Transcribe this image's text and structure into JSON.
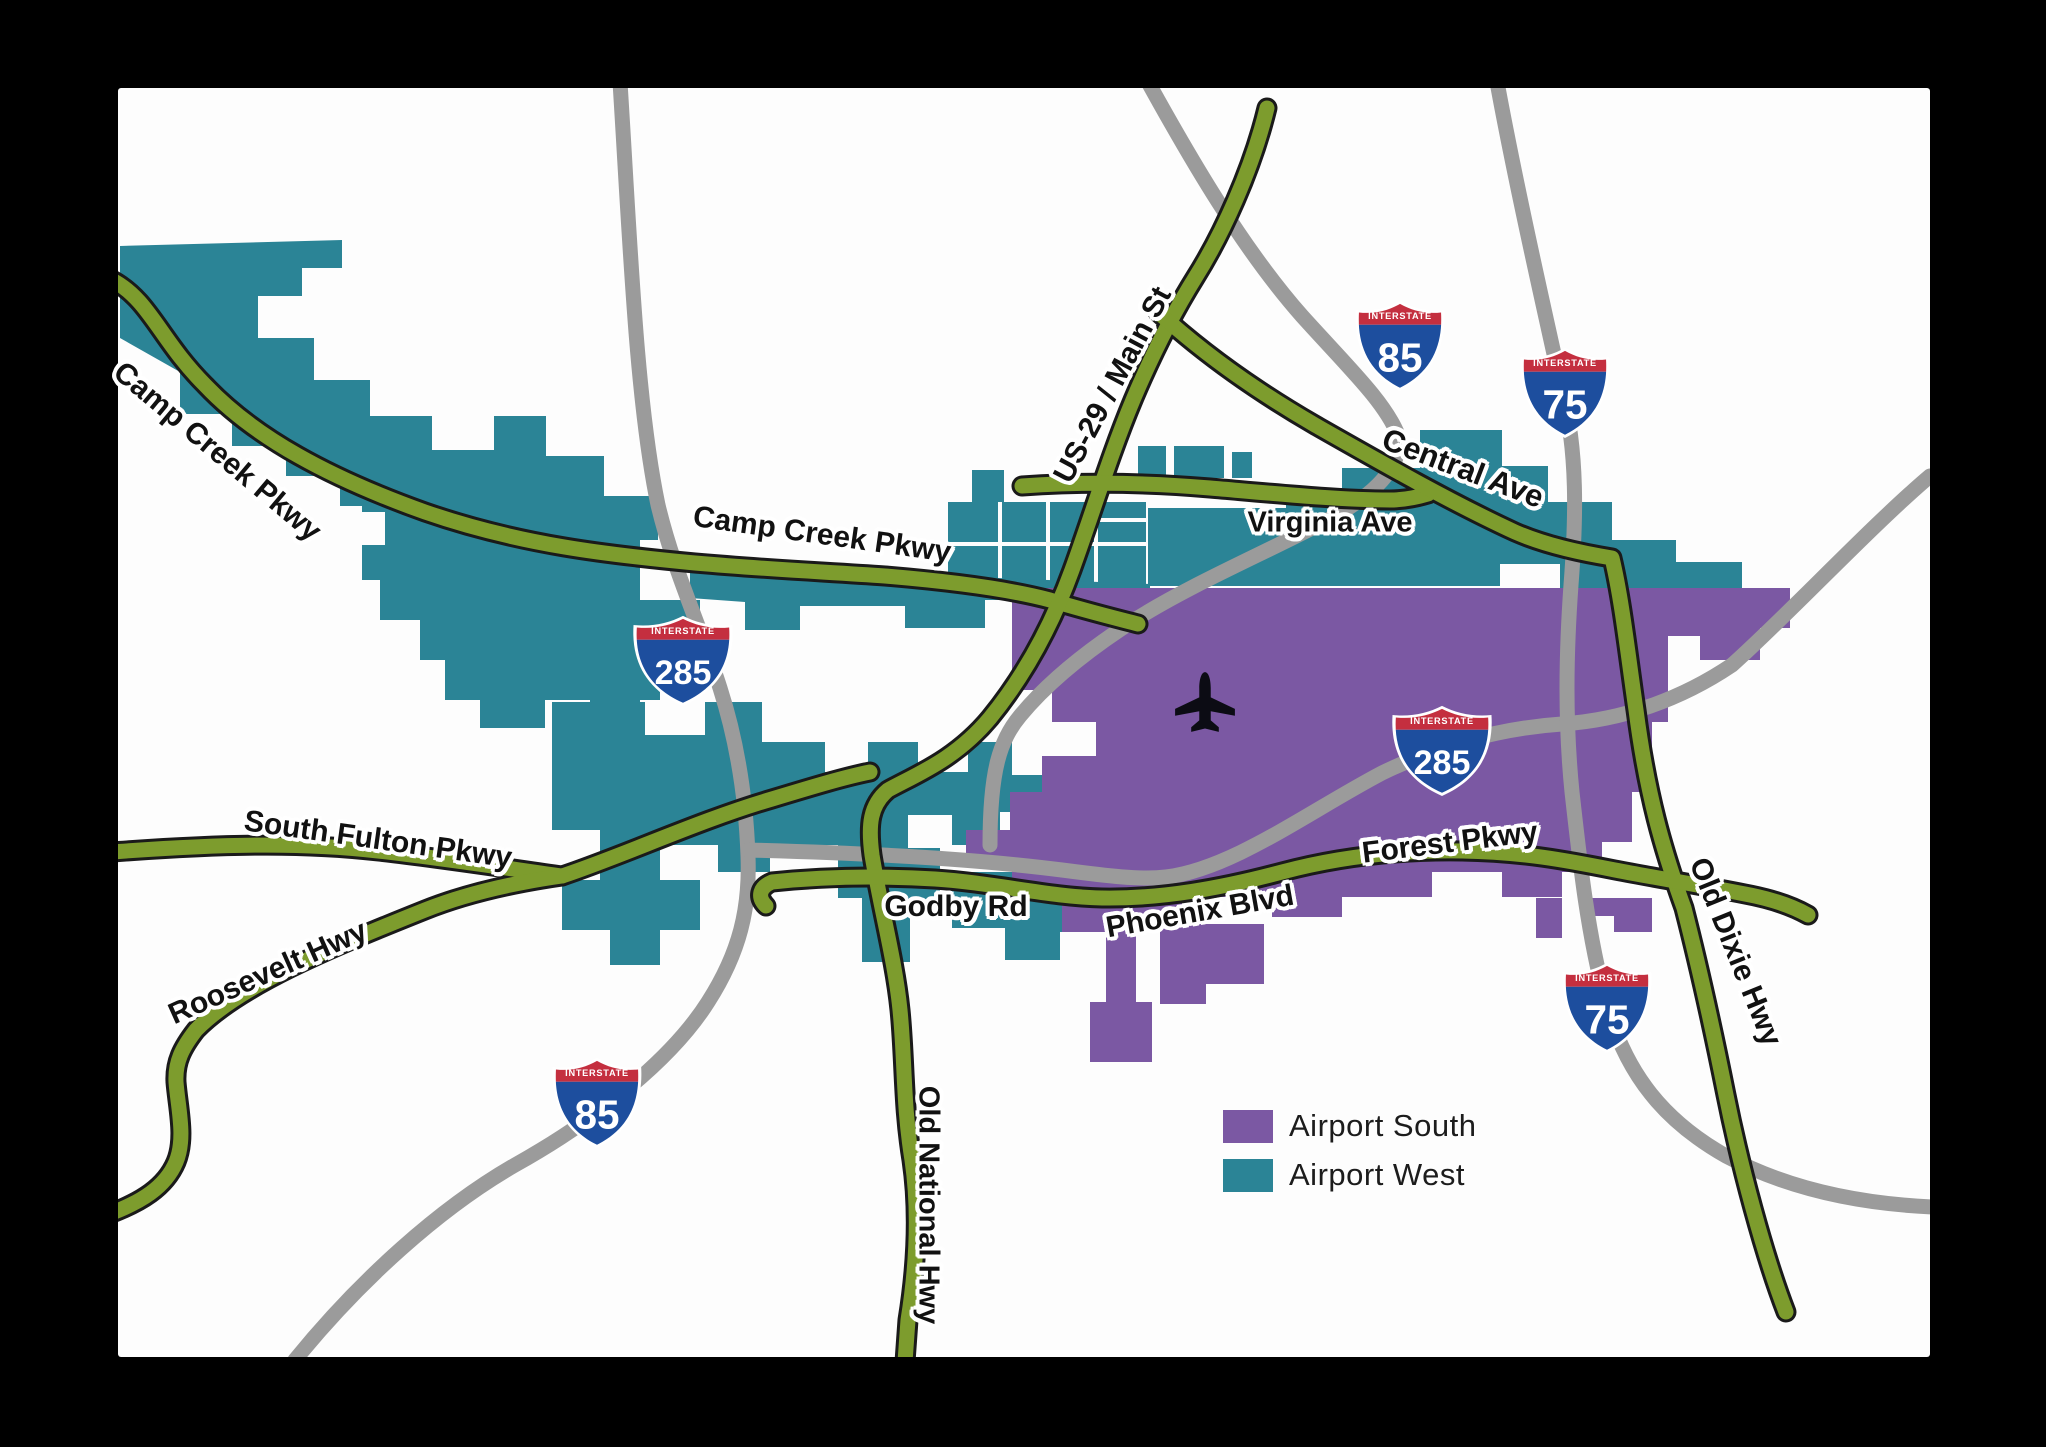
{
  "map": {
    "colors": {
      "frame": "#000000",
      "canvas": "#FDFDFD",
      "airport_west_teal": "#2B8496",
      "airport_south_purple": "#7B58A3",
      "road_green": "#7D9C2D",
      "road_casing": "#1A1A1A",
      "road_grey": "#9B9B9B",
      "shield_blue": "#1D4E9E",
      "shield_red": "#C42F3F",
      "shield_white": "#FFFFFF",
      "label_black": "#111111"
    },
    "legend": {
      "items": [
        {
          "id": "airport-south",
          "label": "Airport South",
          "color_key": "airport_south_purple"
        },
        {
          "id": "airport-west",
          "label": "Airport West",
          "color_key": "airport_west_teal"
        }
      ]
    },
    "road_labels": [
      {
        "id": "camp-creek-pkwy-nw",
        "text": "Camp Creek Pkwy",
        "x": 217,
        "y": 452,
        "rot": 40,
        "size": 30
      },
      {
        "id": "camp-creek-pkwy-center",
        "text": "Camp Creek Pkwy",
        "x": 822,
        "y": 535,
        "rot": 8,
        "size": 30
      },
      {
        "id": "us-29-main-st",
        "text": "US-29 / Main St",
        "x": 1113,
        "y": 385,
        "rot": -62,
        "size": 30
      },
      {
        "id": "central-ave",
        "text": "Central Ave",
        "x": 1463,
        "y": 468,
        "rot": 21,
        "size": 31
      },
      {
        "id": "virginia-ave",
        "text": "Virginia Ave",
        "x": 1330,
        "y": 523,
        "rot": 0,
        "size": 29
      },
      {
        "id": "south-fulton-pkwy",
        "text": "South Fulton Pkwy",
        "x": 378,
        "y": 840,
        "rot": 8,
        "size": 30
      },
      {
        "id": "roosevelt-hwy",
        "text": "Roosevelt Hwy",
        "x": 268,
        "y": 973,
        "rot": -24,
        "size": 30
      },
      {
        "id": "godby-rd",
        "text": "Godby Rd",
        "x": 956,
        "y": 907,
        "rot": 0,
        "size": 30
      },
      {
        "id": "phoenix-blvd",
        "text": "Phoenix Blvd",
        "x": 1200,
        "y": 912,
        "rot": -10,
        "size": 30
      },
      {
        "id": "forest-pkwy",
        "text": "Forest Pkwy",
        "x": 1450,
        "y": 843,
        "rot": -7,
        "size": 30
      },
      {
        "id": "old-dixie-hwy",
        "text": "Old Dixie Hwy",
        "x": 1735,
        "y": 952,
        "rot": 68,
        "size": 30
      },
      {
        "id": "old-national-hwy",
        "text": "Old National Hwy",
        "x": 928,
        "y": 1205,
        "rot": 90,
        "size": 29
      }
    ],
    "shields": [
      {
        "id": "i-85-north",
        "banner": "INTERSTATE",
        "number": "85",
        "x": 1400,
        "y": 345,
        "wide": false
      },
      {
        "id": "i-75-north",
        "banner": "INTERSTATE",
        "number": "75",
        "x": 1565,
        "y": 392,
        "wide": false
      },
      {
        "id": "i-285-west",
        "banner": "INTERSTATE",
        "number": "285",
        "x": 683,
        "y": 660,
        "wide": true
      },
      {
        "id": "i-285-east",
        "banner": "INTERSTATE",
        "number": "285",
        "x": 1442,
        "y": 750,
        "wide": true
      },
      {
        "id": "i-85-south",
        "banner": "INTERSTATE",
        "number": "85",
        "x": 597,
        "y": 1102,
        "wide": false
      },
      {
        "id": "i-75-south",
        "banner": "INTERSTATE",
        "number": "75",
        "x": 1607,
        "y": 1007,
        "wide": false
      }
    ],
    "airplane_icon": {
      "x": 1205,
      "y": 702,
      "scale": 1.15
    }
  }
}
